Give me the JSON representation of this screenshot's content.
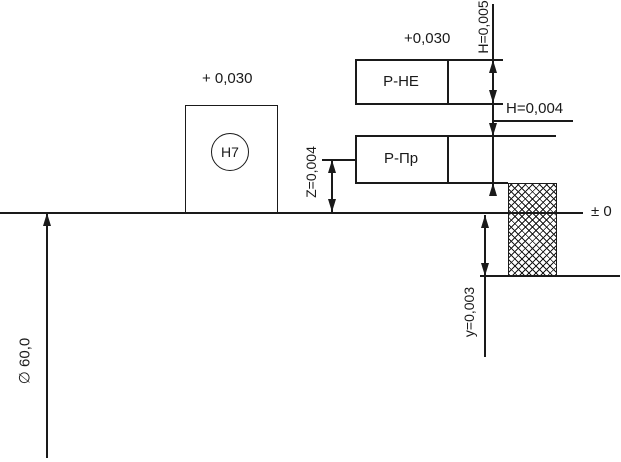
{
  "colors": {
    "ink": "#1a1a1a",
    "paper": "#ffffff"
  },
  "labels": {
    "hole_tolerance_code": "H7",
    "hole_upper_deviation": "+ 0,030",
    "nogo_upper_deviation": "+0,030",
    "nogo_gauge": "Р-НЕ",
    "go_gauge": "Р-Пр",
    "nogo_gauge_tolerance": "H=0,005",
    "go_gauge_tolerance": "H=0,004",
    "go_gauge_position": "Z=0,004",
    "wear_allowance": "y=0,003",
    "zero_line": "± 0",
    "nominal_diameter": "∅ 60,0"
  }
}
